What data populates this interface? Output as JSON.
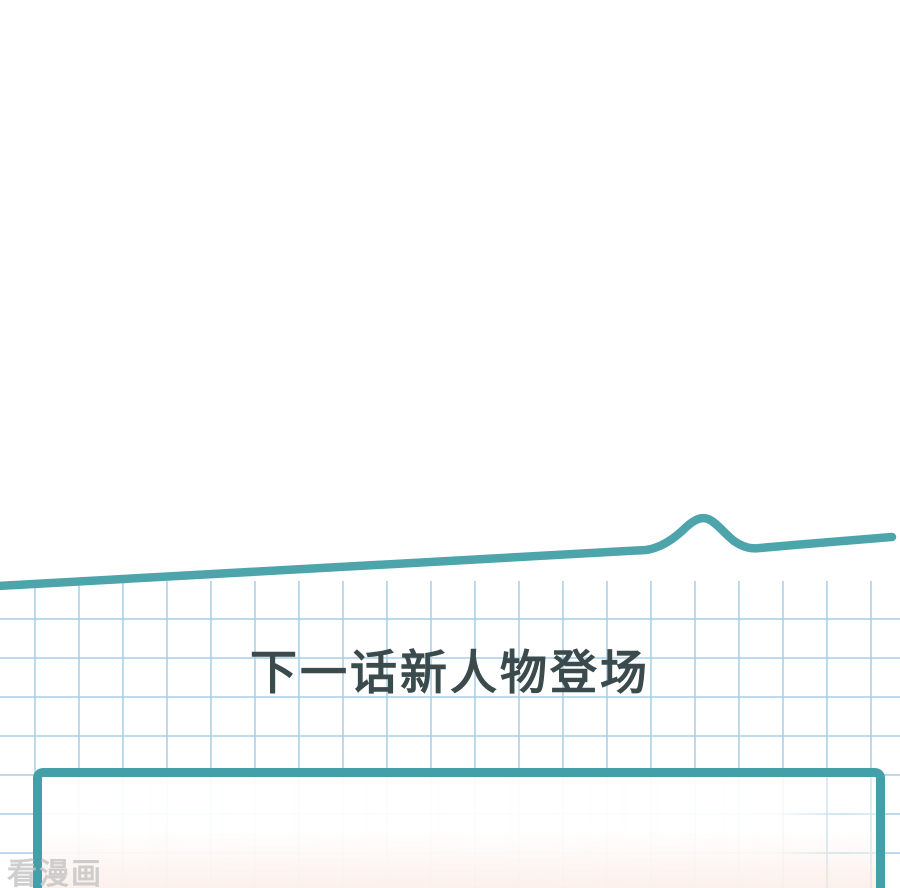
{
  "content": {
    "announcement": "下一话新人物登场",
    "watermark": "看漫画"
  },
  "colors": {
    "background": "#ffffff",
    "torn_edge_line": "#4da5ab",
    "panel_border": "#43a0a8",
    "grid_line": "#a5cee4",
    "announcement_text": "#3a4a4d",
    "watermark_gray": "#c6c6c6",
    "panel_bottom_tint": "#fae5dc"
  }
}
